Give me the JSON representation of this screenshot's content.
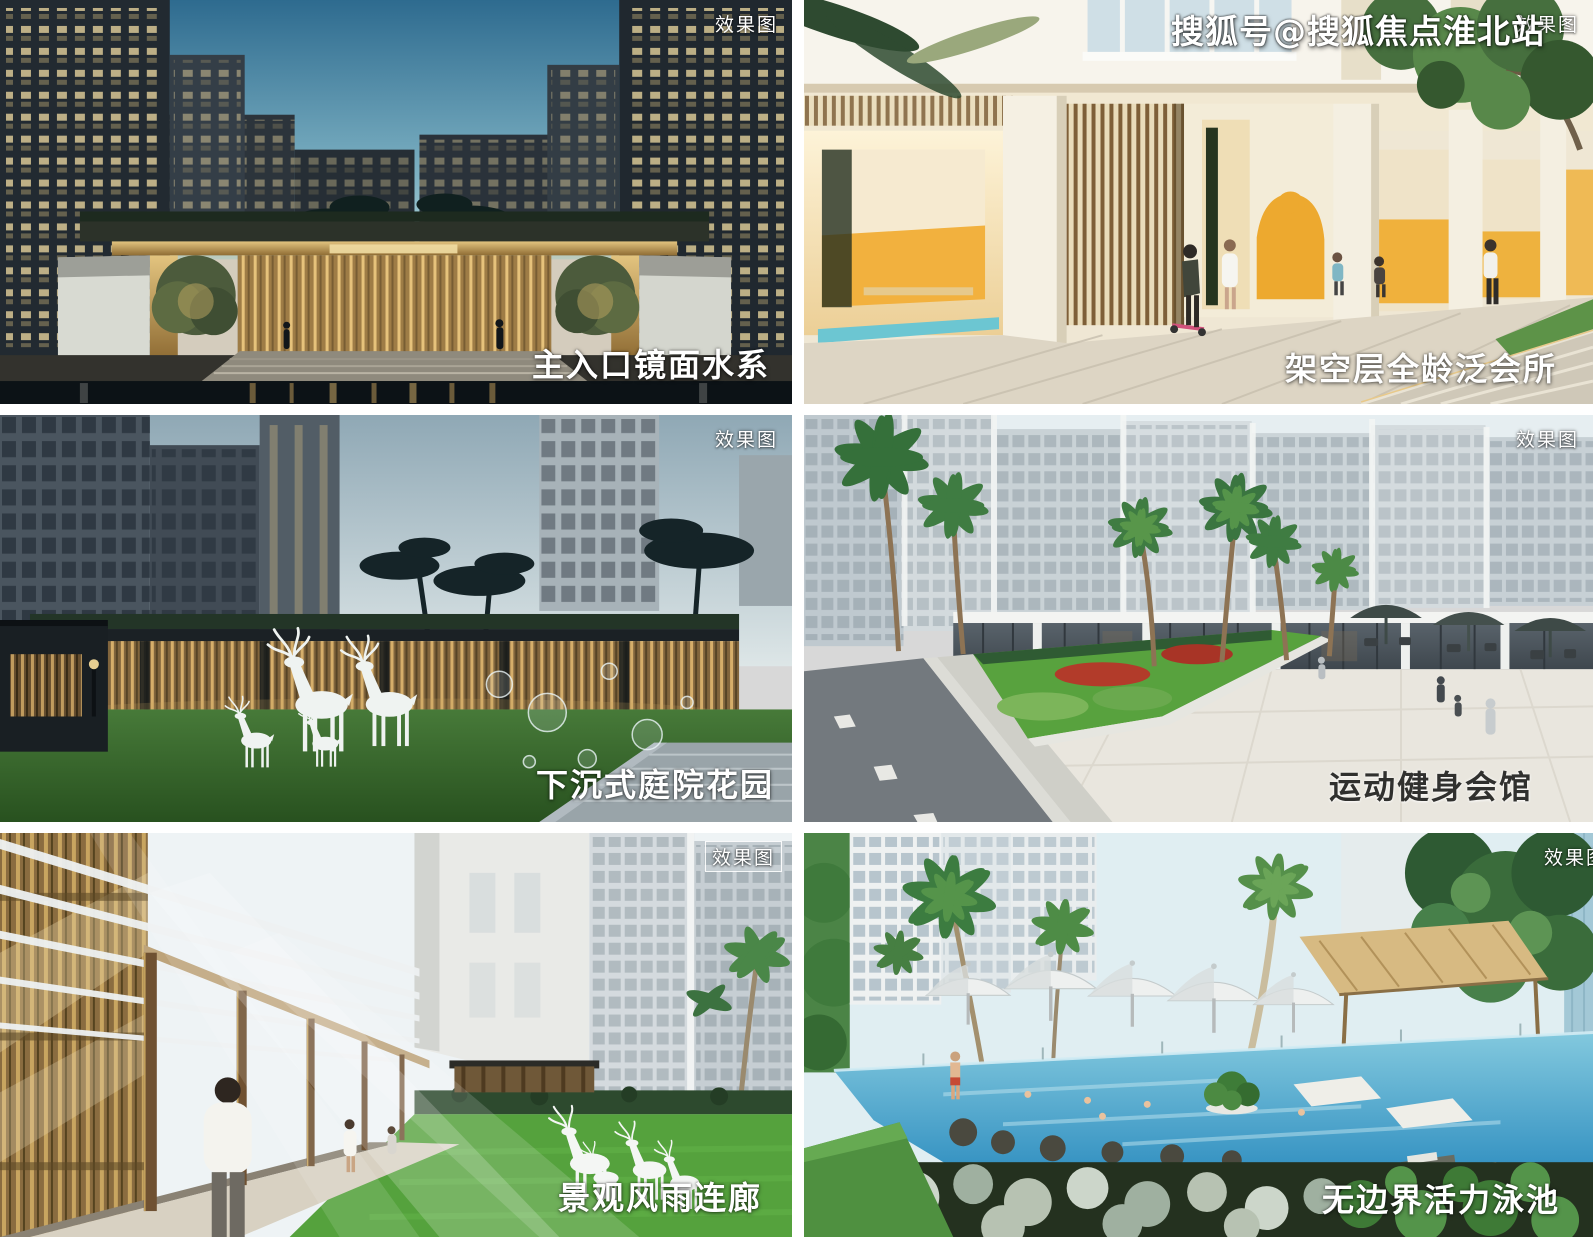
{
  "watermark": {
    "text": "搜狐号@搜狐焦点淮北站"
  },
  "panels": [
    {
      "caption": "主入口镜面水系",
      "badge": "效果图"
    },
    {
      "caption": "架空层全龄泛会所",
      "badge": "效果图"
    },
    {
      "caption": "下沉式庭院花园",
      "badge": "效果图"
    },
    {
      "caption": "运动健身会馆",
      "badge": "效果图"
    },
    {
      "caption": "景观风雨连廊",
      "badge": "效果图"
    },
    {
      "caption": "无边界活力泳池",
      "badge": "效果图"
    }
  ],
  "colors": {
    "accent_yellow": "#f0b13c",
    "pool_blue": "#3a9cc8",
    "lawn_green": "#57a03d",
    "entrance_gold": "#c9a45e",
    "night_sky_teal": "#2e6b8f",
    "dusk_sky": "#8fa8b5"
  }
}
